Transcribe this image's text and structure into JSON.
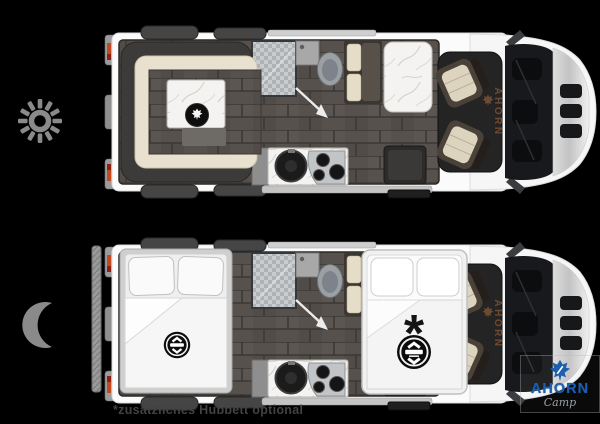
{
  "canvas": {
    "width": 600,
    "height": 424,
    "background": "#000000"
  },
  "legend": {
    "day": {
      "icon": "sun-icon",
      "color": "#8a8a8a"
    },
    "night": {
      "icon": "moon-icon",
      "color": "#8a8a8a"
    }
  },
  "floorplans": {
    "day": {
      "cab_label": "AHORN"
    },
    "night": {
      "cab_label": "AHORN",
      "lift_bed_marker": "*"
    }
  },
  "footnote": {
    "text": "*zusätzliches Hubbett optional"
  },
  "brand_logo": {
    "name": "AHORN",
    "subname": "Camp",
    "leaf_icon": "maple-leaf-icon",
    "name_color": "#1c5fae",
    "subname_color": "#9aa0a5"
  },
  "colors": {
    "background": "#000000",
    "van_body": "#fbfbfb",
    "interior_floor": "#56514d",
    "sofa_charcoal": "#3c3b39",
    "cushion_cream": "#e9e1cf",
    "bedding_white": "#f5f5f5",
    "taillight_orange": "#c2491d",
    "cab_label_brown": "#6e4a31",
    "badge_black": "#0c0c0c",
    "brand_blue": "#1c5fae",
    "footnote_gray": "#424242"
  }
}
